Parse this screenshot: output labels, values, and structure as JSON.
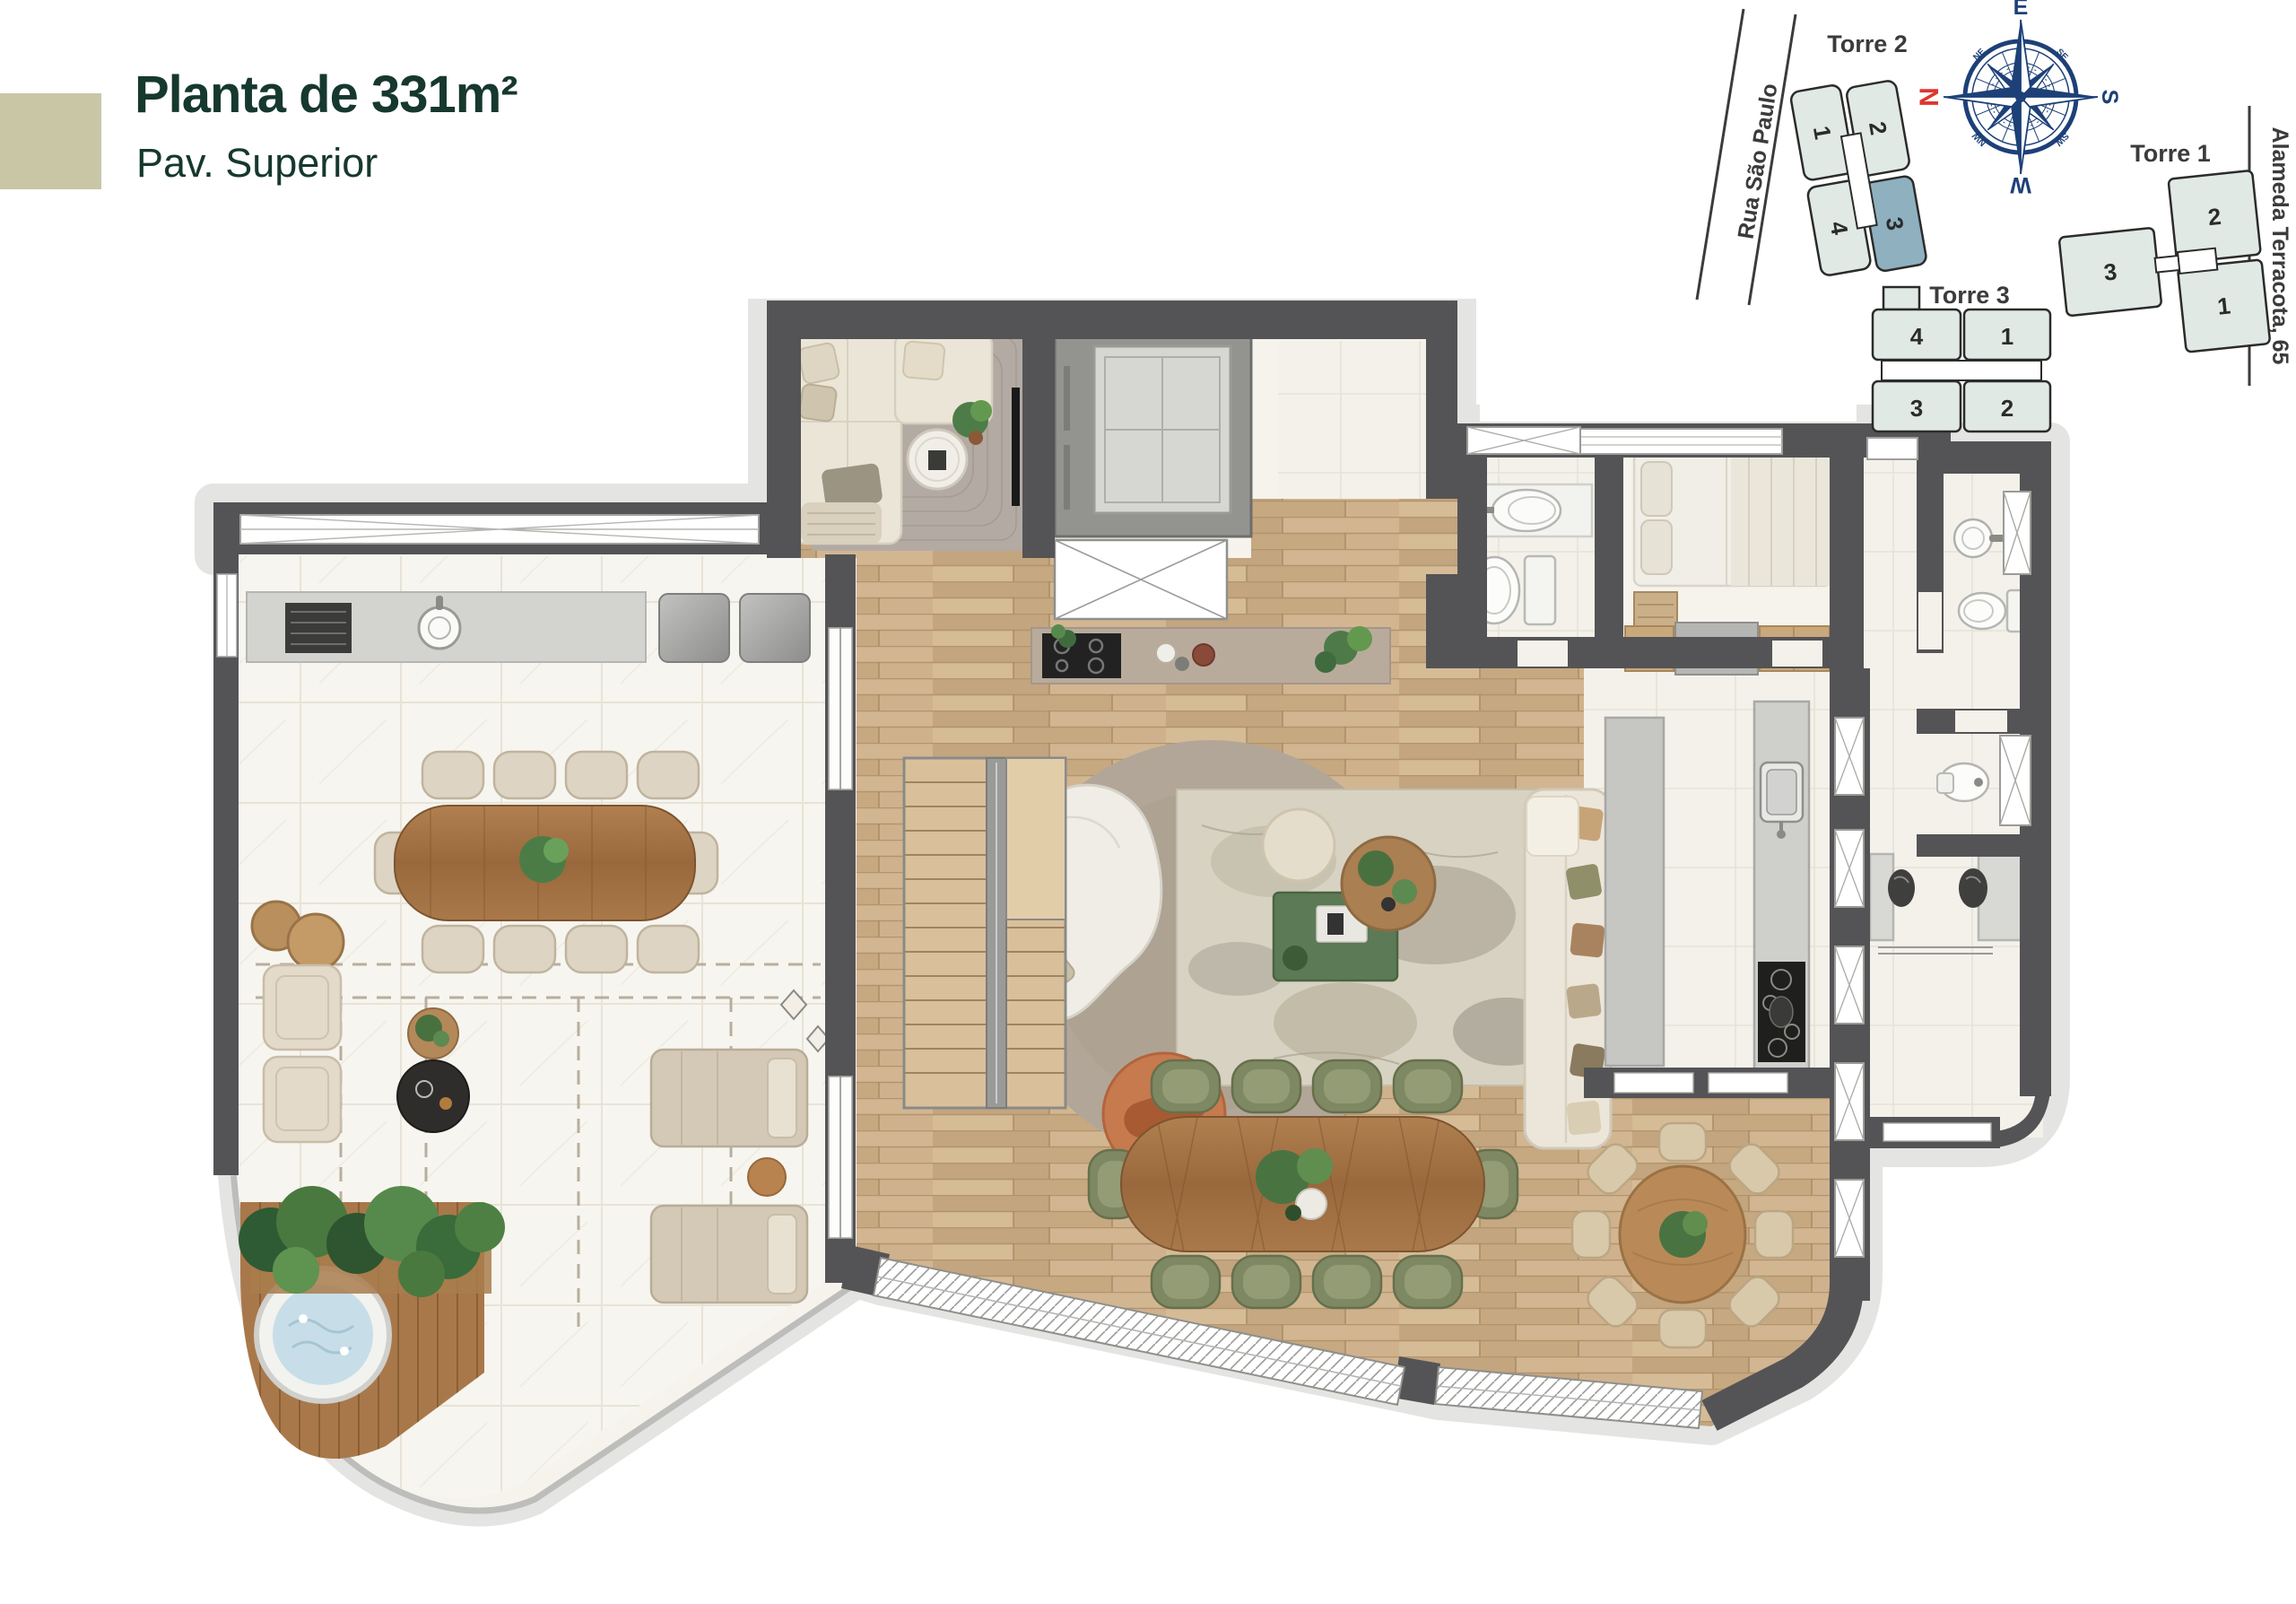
{
  "header": {
    "title": "Planta de 331m²",
    "subtitle": "Pav. Superior"
  },
  "site_map": {
    "street_left": "Rua São Paulo",
    "street_right": "Alameda Terracota, 65",
    "towers": [
      {
        "name": "Torre 2",
        "units": [
          "1",
          "2",
          "4",
          "3"
        ],
        "highlighted_unit": "3"
      },
      {
        "name": "Torre 1",
        "units": [
          "2",
          "3",
          "1"
        ],
        "highlighted_unit": ""
      },
      {
        "name": "Torre 3",
        "units": [
          "4",
          "1",
          "3",
          "2"
        ],
        "highlighted_unit": ""
      }
    ],
    "compass": {
      "north": "N",
      "east": "E",
      "south": "S",
      "west": "W",
      "ne": "NE",
      "se": "SE",
      "sw": "SW",
      "nw": "NW"
    }
  },
  "palette": {
    "title_green": "#16382e",
    "swatch_beige": "#c9c6a6",
    "wall_gray": "#545456",
    "wood_floor": "#cbae8a",
    "marble": "#f5f3ec",
    "terrace_tile": "#f7f5ef",
    "apron_gray": "#e4e4e2",
    "unit_fill": "#e0e9e3",
    "unit_highlight": "#8fb0bf",
    "compass_navy": "#1d4077",
    "north_red": "#e0362c",
    "chair_olive": "#7e8862",
    "table_wood": "#a97c50",
    "rug_round": "#b5a99b",
    "accent_terracotta": "#c67a4e"
  }
}
